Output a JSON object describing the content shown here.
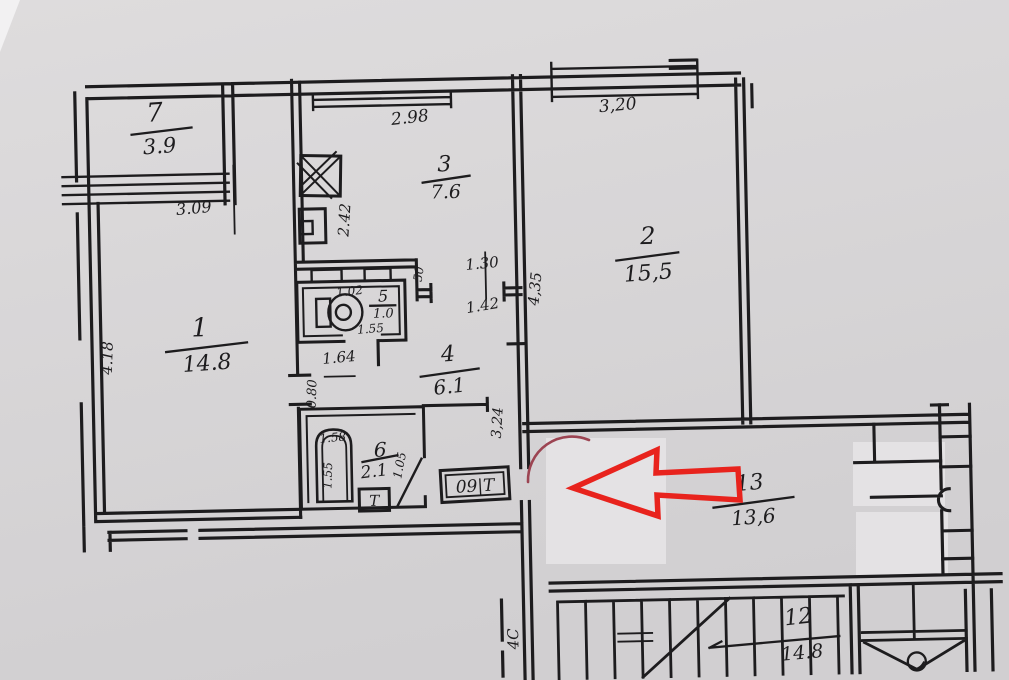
{
  "colors": {
    "paper": "#d6d4d5",
    "patch": "#e4e2e4",
    "ink": "#1d1c1e",
    "arrow_red": "#e8231d",
    "circle_red": "#9c4452"
  },
  "rooms": {
    "balcony": {
      "number": "7",
      "area": "3.9"
    },
    "living": {
      "number": "1",
      "area": "14.8"
    },
    "kitchen": {
      "number": "3",
      "area": "7.6"
    },
    "bedroom": {
      "number": "2",
      "area": "15,5"
    },
    "wc": {
      "number": "5",
      "area": "1.0"
    },
    "hall": {
      "number": "4",
      "area": "6.1"
    },
    "bathroom": {
      "number": "6",
      "area": "2.1"
    },
    "landing": {
      "number": "13",
      "area": "13,6"
    },
    "stairwell": {
      "number": "12",
      "area": "14.8"
    }
  },
  "dimensions": {
    "balcony_width": "3.09",
    "living_depth": "4.18",
    "kitchen_width": "2.98",
    "kitchen_depth": "2.42",
    "bedroom_width": "3,20",
    "bedroom_depth": "4,35",
    "opening_kitchen_hall": "1.30",
    "hall_width": "1.42",
    "niche": "50",
    "wc_width": "1.02",
    "wc_depth": "1.55",
    "corridor_width": "1.64",
    "living_door": "0.80",
    "tub_length": "1.58",
    "tub_width": "1.55",
    "bath_door": "1.05",
    "entry_depth": "3,24",
    "stair_mark": "4С"
  },
  "fixtures": {
    "meter_box_label": "09|Т",
    "towel_rail_label": "Т"
  },
  "annotation": {
    "direction_note": "left"
  }
}
